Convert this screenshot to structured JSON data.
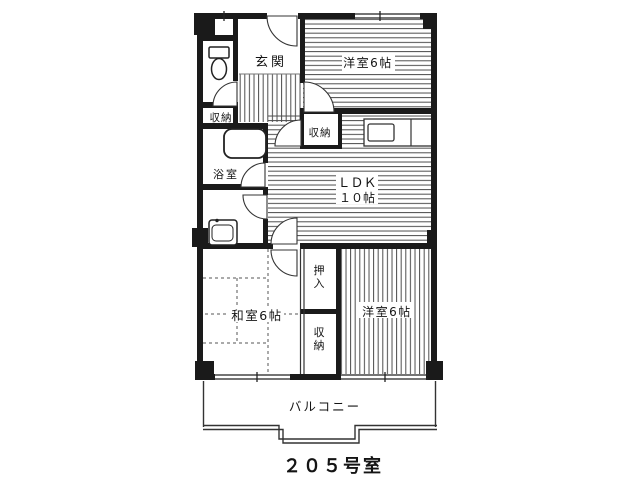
{
  "plan": {
    "room_number": "２０５号室",
    "rooms": {
      "genkan": "玄関",
      "western_top": "洋室6帖",
      "ldk_line1": "ＬＤＫ",
      "ldk_line2": "１０帖",
      "storage_left": "収納",
      "storage_center": "収納",
      "storage_bottom": "収納",
      "oshiire": "押入",
      "bath": "浴室",
      "washitsu": "和室6帖",
      "western_bottom": "洋室6帖",
      "balcony": "バルコニー"
    },
    "colors": {
      "wall": "#1a1a1a",
      "hatch": "#4d4d4d",
      "line": "#333333"
    }
  }
}
